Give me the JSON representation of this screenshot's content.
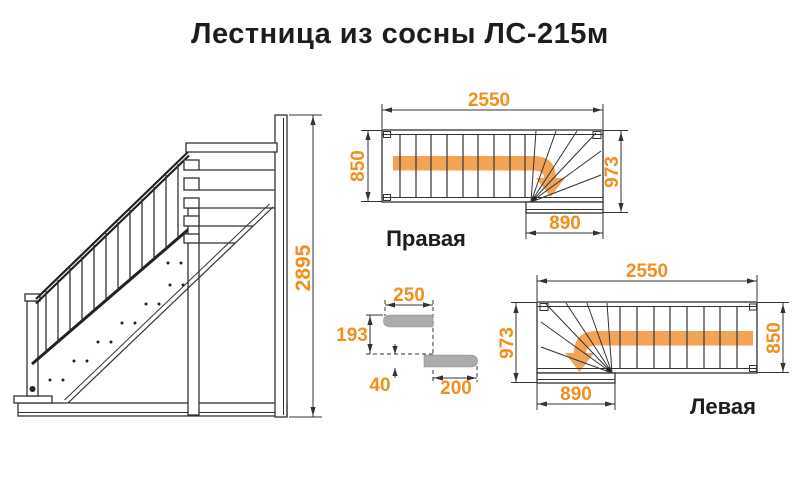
{
  "title": "Лестница из сосны ЛС-215м",
  "colors": {
    "dimension_text": "#F28E1C",
    "direction_arrow": "#F1A458",
    "drawing_lines": "#333333",
    "tread_gray": "#A9ABAD",
    "label_text": "#1D1D1D"
  },
  "side_view": {
    "total_height": "2895"
  },
  "plan_right": {
    "label": "Правая",
    "total_length": "2550",
    "flight_width": "850",
    "turn_width": "973",
    "landing_width": "890"
  },
  "plan_left": {
    "label": "Левая",
    "total_length": "2550",
    "flight_width": "850",
    "turn_width": "973",
    "landing_width": "890"
  },
  "step_detail": {
    "tread_depth": "250",
    "riser_height": "193",
    "tread_thickness": "40",
    "tread_run": "200"
  }
}
